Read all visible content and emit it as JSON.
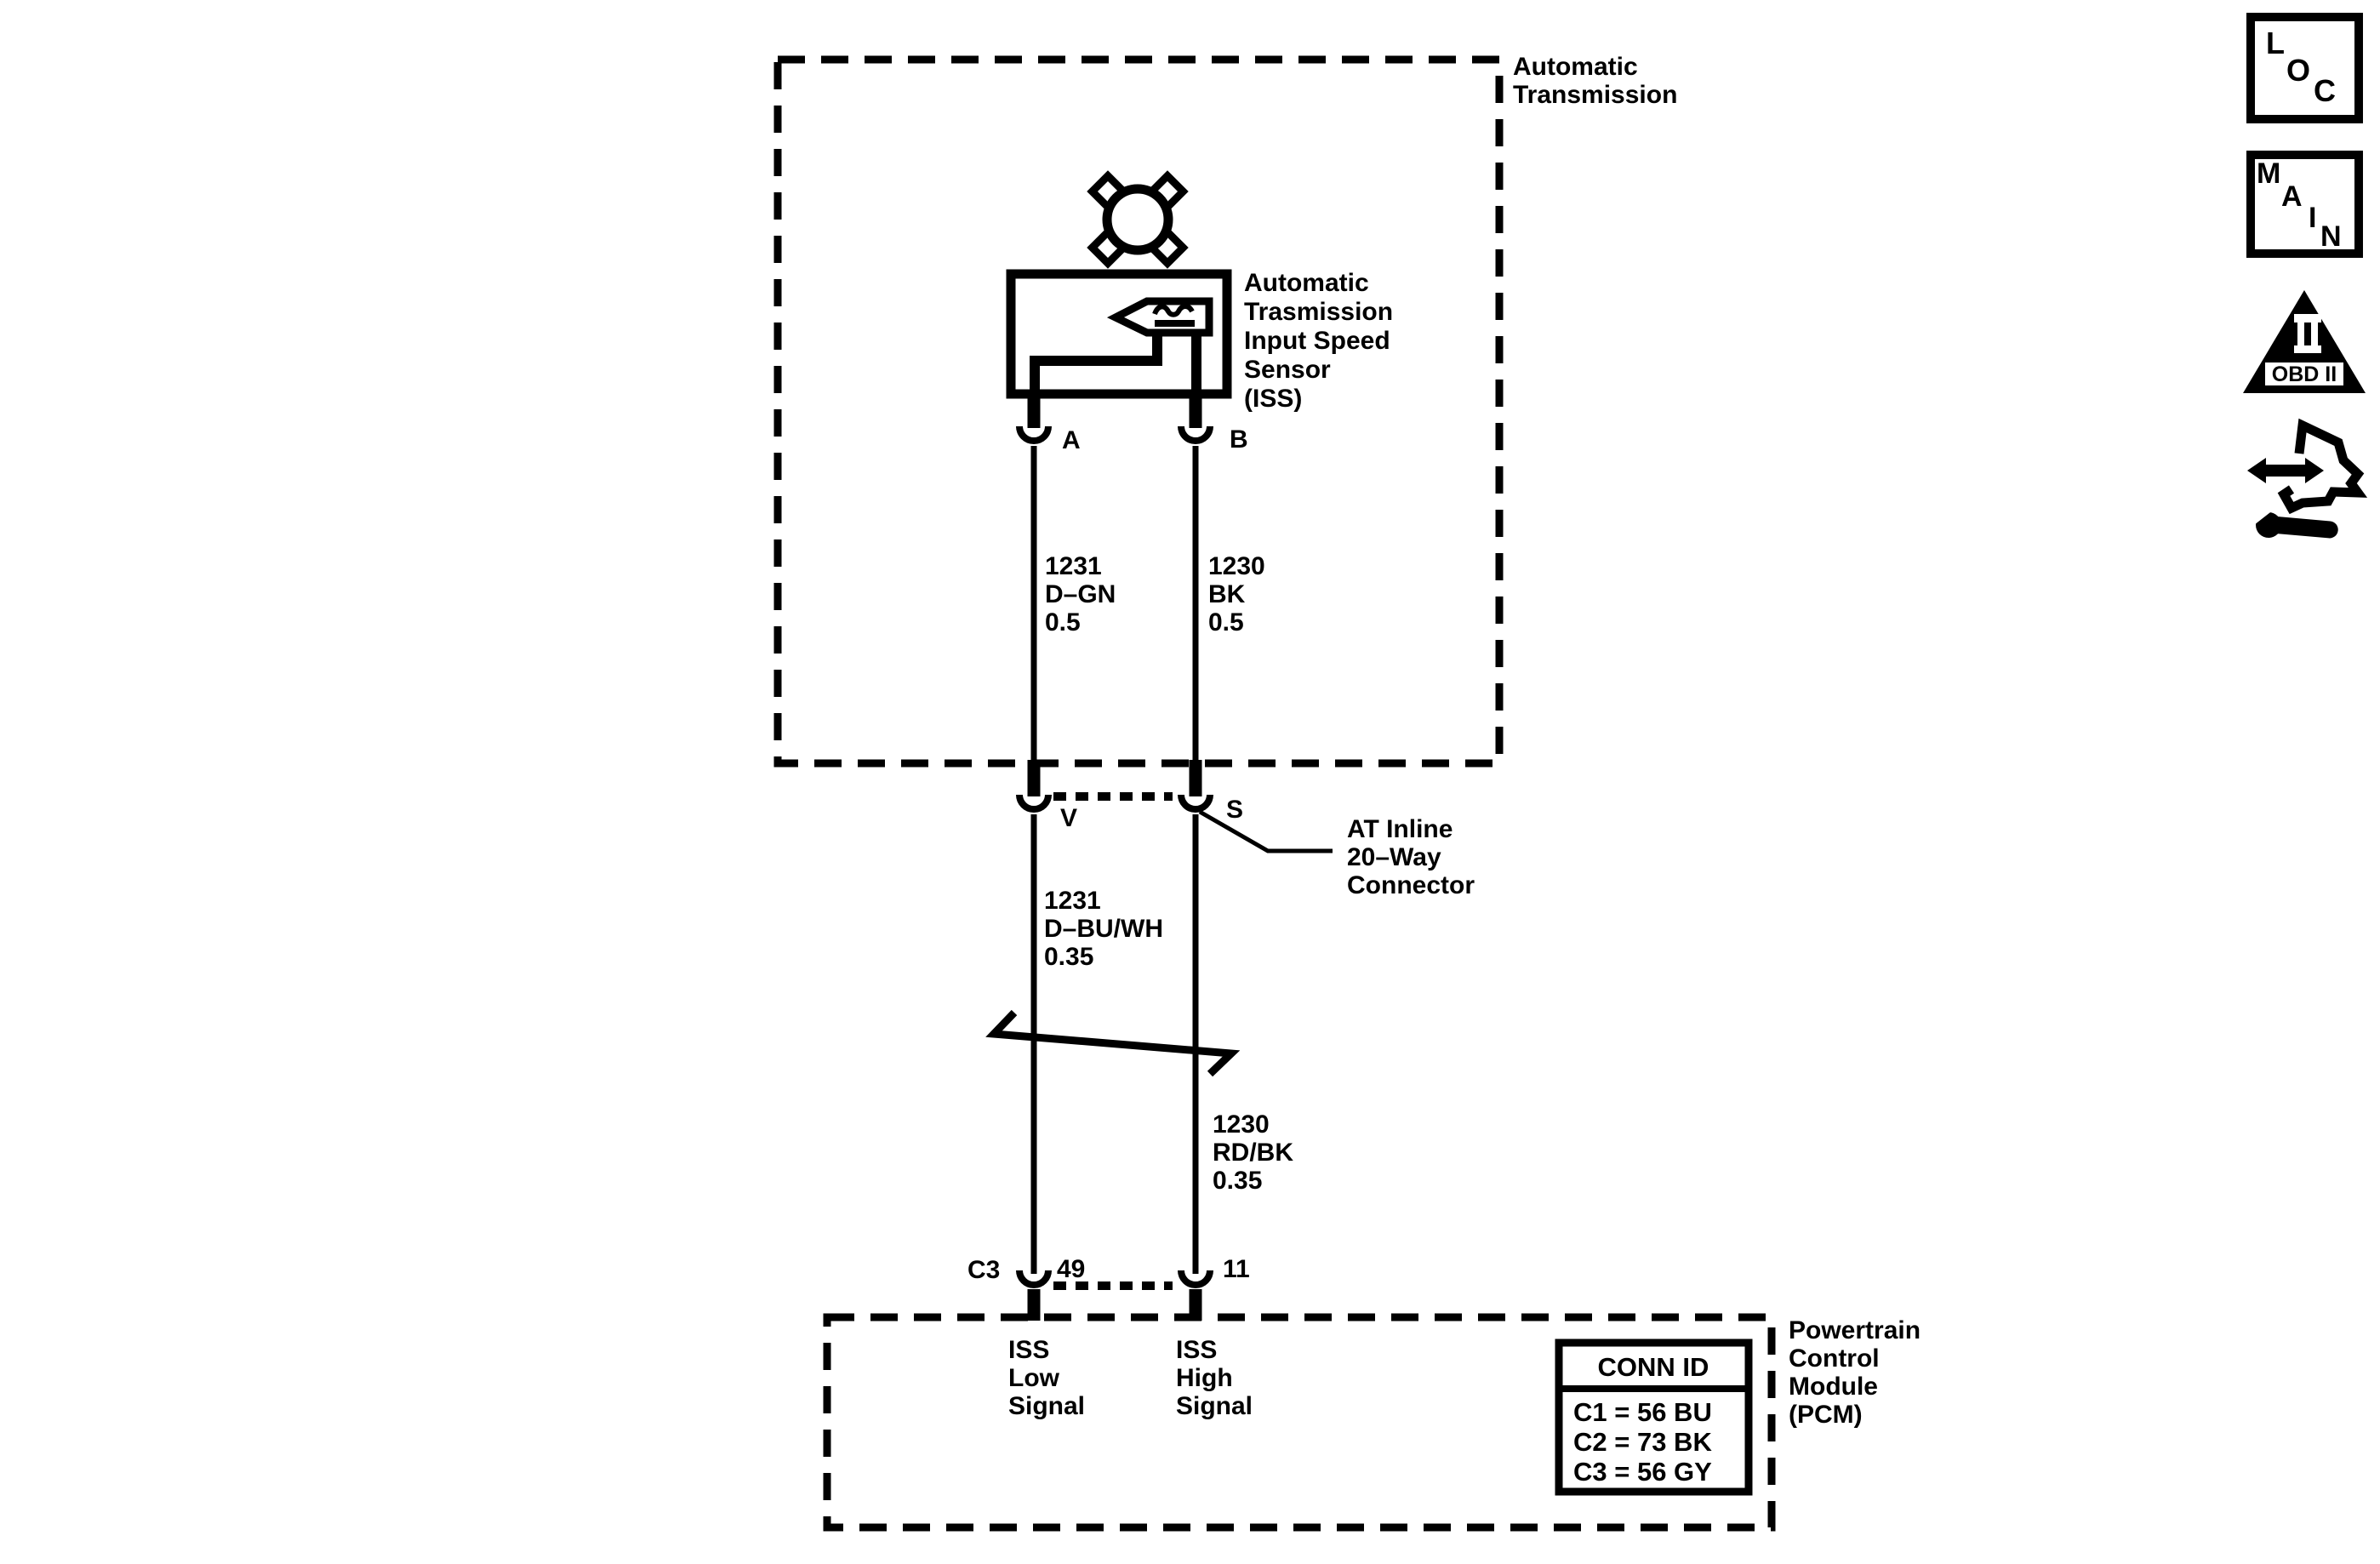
{
  "colors": {
    "ink": "#000000",
    "paper": "#ffffff"
  },
  "boxes": {
    "transmission": {
      "label": [
        "Automatic",
        "Transmission"
      ]
    },
    "pcm": {
      "label": [
        "Powertrain",
        "Control",
        "Module",
        "(PCM)"
      ]
    }
  },
  "sensor": {
    "label": [
      "Automatic",
      "Trasmission",
      "Input Speed",
      "Sensor",
      "(ISS)"
    ]
  },
  "pins": {
    "a": "A",
    "b": "B",
    "v": "V",
    "s": "S",
    "c3": "C3",
    "pin49": "49",
    "pin11": "11"
  },
  "wires": {
    "upper_left": [
      "1231",
      "D–GN",
      "0.5"
    ],
    "upper_right": [
      "1230",
      "BK",
      "0.5"
    ],
    "lower_left": [
      "1231",
      "D–BU/WH",
      "0.35"
    ],
    "lower_right": [
      "1230",
      "RD/BK",
      "0.35"
    ]
  },
  "inline_connector": {
    "label": [
      "AT Inline",
      "20–Way",
      "Connector"
    ]
  },
  "pcm_signals": {
    "low": [
      "ISS",
      "Low",
      "Signal"
    ],
    "high": [
      "ISS",
      "High",
      "Signal"
    ]
  },
  "conn_id_table": {
    "header": "CONN ID",
    "rows": [
      "C1 = 56 BU",
      "C2 = 73 BK",
      "C3 = 56 GY"
    ]
  },
  "nav_icons": {
    "loc": [
      "L",
      "O",
      "C"
    ],
    "main": [
      "M",
      "A",
      "I",
      "N"
    ],
    "obd": {
      "label": "OBD II"
    }
  }
}
